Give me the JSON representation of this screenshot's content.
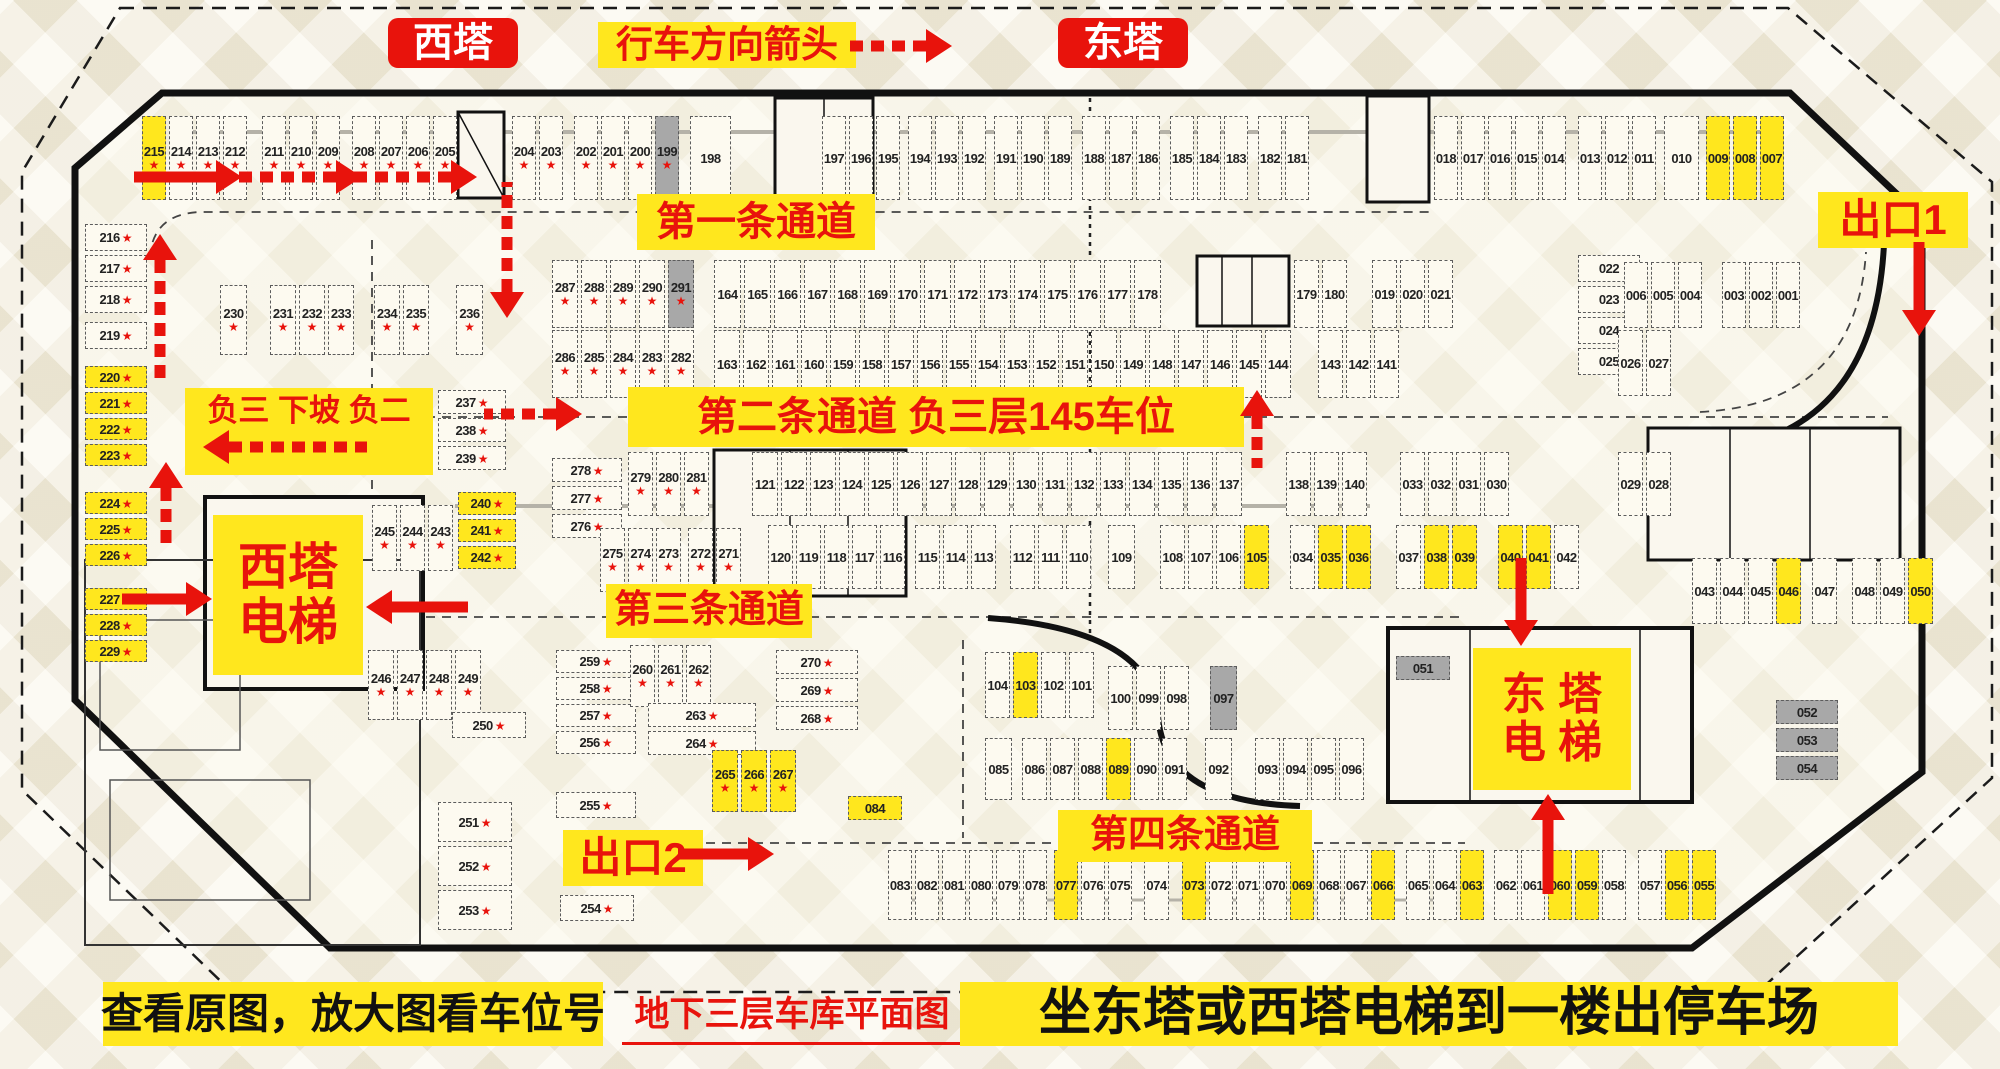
{
  "header": {
    "west_tower": "西塔",
    "direction_label": "行车方向箭头",
    "east_tower": "东塔"
  },
  "labels": {
    "lane1": "第一条通道",
    "lane2": "第二条通道 负三层145车位",
    "lane3": "第三条通道",
    "lane4": "第四条通道",
    "exit1": "出口1",
    "exit2": "出口2",
    "ramp_note": "负三 下坡 负二",
    "west_elevator_line1": "西塔",
    "west_elevator_line2": "电梯",
    "east_elevator_line1": "东 塔",
    "east_elevator_line2": "电 梯"
  },
  "footer": {
    "left_note": "查看原图，放大图看车位号",
    "center_title": "地下三层车库平面图",
    "right_note": "坐东塔或西塔电梯到一楼出停车场"
  },
  "colors": {
    "accent_red": "#e8130c",
    "highlight_yellow": "#ffe71e",
    "occupied_gray": "#a8a8a8",
    "star_red": "#e8130c"
  },
  "legend_note": "cell flags: y=yellow highlight, g=gray, s=red star",
  "groups": [
    {
      "id": "top-215",
      "o": "v",
      "x": 142,
      "y": 116,
      "cw": 27,
      "ch": 84,
      "cells": [
        "215:ys",
        "214:s",
        "213:s",
        "212:s"
      ]
    },
    {
      "id": "top-211",
      "o": "v",
      "x": 262,
      "y": 116,
      "cw": 27,
      "ch": 84,
      "cells": [
        "211:s",
        "210:s",
        "209:s"
      ]
    },
    {
      "id": "top-208",
      "o": "v",
      "x": 352,
      "y": 116,
      "cw": 27,
      "ch": 84,
      "cells": [
        "208:s",
        "207:s"
      ]
    },
    {
      "id": "top-206",
      "o": "v",
      "x": 406,
      "y": 116,
      "cw": 27,
      "ch": 84,
      "cells": [
        "206:s",
        "205:s"
      ]
    },
    {
      "id": "top-204",
      "o": "v",
      "x": 512,
      "y": 116,
      "cw": 27,
      "ch": 84,
      "cells": [
        "204:s",
        "203:s"
      ]
    },
    {
      "id": "top-202",
      "o": "v",
      "x": 574,
      "y": 116,
      "cw": 27,
      "ch": 84,
      "cells": [
        "202:s",
        "201:s",
        "200:s",
        "199:sg"
      ]
    },
    {
      "id": "top-198",
      "o": "v",
      "x": 690,
      "y": 116,
      "cw": 44,
      "ch": 84,
      "cells": [
        "198"
      ]
    },
    {
      "id": "top-197",
      "o": "v",
      "x": 822,
      "y": 116,
      "cw": 27,
      "ch": 84,
      "cells": [
        "197",
        "196",
        "195"
      ]
    },
    {
      "id": "top-194",
      "o": "v",
      "x": 908,
      "y": 116,
      "cw": 27,
      "ch": 84,
      "cells": [
        "194",
        "193",
        "192"
      ]
    },
    {
      "id": "top-191",
      "o": "v",
      "x": 994,
      "y": 116,
      "cw": 27,
      "ch": 84,
      "cells": [
        "191",
        "190",
        "189"
      ]
    },
    {
      "id": "top-188",
      "o": "v",
      "x": 1082,
      "y": 116,
      "cw": 27,
      "ch": 84,
      "cells": [
        "188",
        "187",
        "186"
      ]
    },
    {
      "id": "top-185",
      "o": "v",
      "x": 1170,
      "y": 116,
      "cw": 27,
      "ch": 84,
      "cells": [
        "185",
        "184",
        "183"
      ]
    },
    {
      "id": "top-182",
      "o": "v",
      "x": 1258,
      "y": 116,
      "cw": 27,
      "ch": 84,
      "cells": [
        "182",
        "181"
      ]
    },
    {
      "id": "top-018",
      "o": "v",
      "x": 1434,
      "y": 116,
      "cw": 27,
      "ch": 84,
      "cells": [
        "018",
        "017",
        "016",
        "015",
        "014"
      ]
    },
    {
      "id": "top-013",
      "o": "v",
      "x": 1578,
      "y": 116,
      "cw": 27,
      "ch": 84,
      "cells": [
        "013",
        "012",
        "011"
      ]
    },
    {
      "id": "top-010",
      "o": "v",
      "x": 1664,
      "y": 116,
      "cw": 38,
      "ch": 84,
      "cells": [
        "010"
      ]
    },
    {
      "id": "top-009",
      "o": "v",
      "x": 1706,
      "y": 116,
      "cw": 27,
      "ch": 84,
      "cells": [
        "009:y",
        "008:y",
        "007:y"
      ]
    },
    {
      "id": "left-216",
      "o": "h",
      "x": 85,
      "y": 224,
      "cw": 62,
      "ch": 31,
      "cells": [
        "216:s",
        "217:s",
        "218:s"
      ]
    },
    {
      "id": "left-219",
      "o": "h",
      "x": 85,
      "y": 322,
      "cw": 62,
      "ch": 31,
      "cells": [
        "219:s"
      ]
    },
    {
      "id": "left-220",
      "o": "h",
      "x": 85,
      "y": 366,
      "cw": 62,
      "ch": 26,
      "cells": [
        "220:ys",
        "221:ys",
        "222:ys",
        "223:ys"
      ]
    },
    {
      "id": "left-224",
      "o": "h",
      "x": 85,
      "y": 492,
      "cw": 62,
      "ch": 26,
      "cells": [
        "224:ys",
        "225:ys",
        "226:ys"
      ]
    },
    {
      "id": "left-227",
      "o": "h",
      "x": 85,
      "y": 588,
      "cw": 62,
      "ch": 26,
      "cells": [
        "227:ys",
        "228:ys",
        "229:ys"
      ]
    },
    {
      "id": "row2-230",
      "o": "v",
      "x": 220,
      "y": 285,
      "cw": 30,
      "ch": 70,
      "cells": [
        "230:s"
      ]
    },
    {
      "id": "row2-231",
      "o": "v",
      "x": 270,
      "y": 285,
      "cw": 29,
      "ch": 70,
      "cells": [
        "231:s",
        "232:s",
        "233:s"
      ]
    },
    {
      "id": "row2-234",
      "o": "v",
      "x": 374,
      "y": 285,
      "cw": 29,
      "ch": 70,
      "cells": [
        "234:s",
        "235:s"
      ]
    },
    {
      "id": "row2-236",
      "o": "v",
      "x": 456,
      "y": 285,
      "cw": 30,
      "ch": 70,
      "cells": [
        "236:s"
      ]
    },
    {
      "id": "c-287",
      "o": "v",
      "x": 552,
      "y": 260,
      "cw": 29,
      "ch": 68,
      "cells": [
        "287:s",
        "288:s",
        "289:s",
        "290:s",
        "291:sg"
      ]
    },
    {
      "id": "c-286",
      "o": "v",
      "x": 552,
      "y": 330,
      "cw": 29,
      "ch": 68,
      "cells": [
        "286:s",
        "285:s",
        "284:s",
        "283:s",
        "282:s"
      ]
    },
    {
      "id": "c-164",
      "o": "v",
      "x": 714,
      "y": 260,
      "cw": 30,
      "ch": 68,
      "cells": [
        "164",
        "165",
        "166",
        "167",
        "168",
        "169",
        "170",
        "171",
        "172",
        "173",
        "174",
        "175",
        "176",
        "177",
        "178"
      ]
    },
    {
      "id": "c-179",
      "o": "v",
      "x": 1294,
      "y": 260,
      "cw": 28,
      "ch": 68,
      "cells": [
        "179",
        "180"
      ]
    },
    {
      "id": "c-019",
      "o": "v",
      "x": 1372,
      "y": 260,
      "cw": 28,
      "ch": 68,
      "cells": [
        "019",
        "020",
        "021"
      ]
    },
    {
      "id": "c-163",
      "o": "v",
      "x": 714,
      "y": 330,
      "cw": 29,
      "ch": 68,
      "cells": [
        "163",
        "162",
        "161",
        "160",
        "159",
        "158",
        "157",
        "156",
        "155",
        "154",
        "153",
        "152",
        "151",
        "150",
        "149",
        "148",
        "147",
        "146",
        "145",
        "144"
      ]
    },
    {
      "id": "c-143",
      "o": "v",
      "x": 1318,
      "y": 330,
      "cw": 28,
      "ch": 68,
      "cells": [
        "143",
        "142",
        "141"
      ]
    },
    {
      "id": "rb-022",
      "o": "h",
      "x": 1578,
      "y": 255,
      "cw": 62,
      "ch": 31,
      "cells": [
        "022",
        "023",
        "024",
        "025"
      ]
    },
    {
      "id": "rb-006",
      "o": "v",
      "x": 1624,
      "y": 262,
      "cw": 27,
      "ch": 66,
      "cells": [
        "006",
        "005",
        "004"
      ]
    },
    {
      "id": "rb-003",
      "o": "v",
      "x": 1722,
      "y": 262,
      "cw": 27,
      "ch": 66,
      "cells": [
        "003",
        "002",
        "001"
      ]
    },
    {
      "id": "rb-026",
      "o": "v",
      "x": 1618,
      "y": 330,
      "cw": 28,
      "ch": 66,
      "cells": [
        "026",
        "027"
      ]
    },
    {
      "id": "m-237",
      "o": "h",
      "x": 438,
      "y": 390,
      "cw": 68,
      "ch": 28,
      "cells": [
        "237:s",
        "238:s",
        "239:s"
      ]
    },
    {
      "id": "m-240",
      "o": "h",
      "x": 458,
      "y": 492,
      "cw": 58,
      "ch": 27,
      "cells": [
        "240:ys",
        "241:ys",
        "242:ys"
      ]
    },
    {
      "id": "m-245",
      "o": "v",
      "x": 372,
      "y": 505,
      "cw": 28,
      "ch": 66,
      "cells": [
        "245:s",
        "244:s",
        "243:s"
      ]
    },
    {
      "id": "n-278",
      "o": "h",
      "x": 552,
      "y": 458,
      "cw": 70,
      "ch": 28,
      "cells": [
        "278:s",
        "277:s",
        "276:s"
      ]
    },
    {
      "id": "n-279",
      "o": "v",
      "x": 628,
      "y": 452,
      "cw": 28,
      "ch": 64,
      "cells": [
        "279:s",
        "280:s",
        "281:s"
      ]
    },
    {
      "id": "n-275",
      "o": "v",
      "x": 600,
      "y": 528,
      "cw": 28,
      "ch": 64,
      "cells": [
        "275:s",
        "274:s",
        "273:s"
      ]
    },
    {
      "id": "n-272",
      "o": "v",
      "x": 688,
      "y": 528,
      "cw": 28,
      "ch": 64,
      "cells": [
        "272:s",
        "271:s"
      ]
    },
    {
      "id": "n-121",
      "o": "v",
      "x": 752,
      "y": 452,
      "cw": 29,
      "ch": 64,
      "cells": [
        "121",
        "122",
        "123",
        "124",
        "125",
        "126",
        "127",
        "128",
        "129",
        "130",
        "131",
        "132",
        "133",
        "134",
        "135",
        "136",
        "137"
      ]
    },
    {
      "id": "n-138",
      "o": "v",
      "x": 1286,
      "y": 452,
      "cw": 28,
      "ch": 64,
      "cells": [
        "138",
        "139",
        "140"
      ]
    },
    {
      "id": "n-033",
      "o": "v",
      "x": 1400,
      "y": 452,
      "cw": 28,
      "ch": 64,
      "cells": [
        "033",
        "032",
        "031",
        "030"
      ]
    },
    {
      "id": "n-029",
      "o": "v",
      "x": 1618,
      "y": 452,
      "cw": 28,
      "ch": 64,
      "cells": [
        "029",
        "028"
      ]
    },
    {
      "id": "n-120",
      "o": "v",
      "x": 768,
      "y": 525,
      "cw": 28,
      "ch": 64,
      "cells": [
        "120",
        "119",
        "118",
        "117",
        "116"
      ]
    },
    {
      "id": "n-115",
      "o": "v",
      "x": 915,
      "y": 525,
      "cw": 28,
      "ch": 64,
      "cells": [
        "115",
        "114",
        "113"
      ]
    },
    {
      "id": "n-112",
      "o": "v",
      "x": 1010,
      "y": 525,
      "cw": 28,
      "ch": 64,
      "cells": [
        "112",
        "111",
        "110"
      ]
    },
    {
      "id": "n-109",
      "o": "v",
      "x": 1108,
      "y": 525,
      "cw": 30,
      "ch": 64,
      "cells": [
        "109"
      ]
    },
    {
      "id": "n-108",
      "o": "v",
      "x": 1160,
      "y": 525,
      "cw": 28,
      "ch": 64,
      "cells": [
        "108",
        "107",
        "106",
        "105:y"
      ]
    },
    {
      "id": "n-034",
      "o": "v",
      "x": 1290,
      "y": 525,
      "cw": 28,
      "ch": 64,
      "cells": [
        "034",
        "035:y",
        "036:y"
      ]
    },
    {
      "id": "n-037",
      "o": "v",
      "x": 1396,
      "y": 525,
      "cw": 28,
      "ch": 64,
      "cells": [
        "037",
        "038:y",
        "039:y"
      ]
    },
    {
      "id": "n-040",
      "o": "v",
      "x": 1498,
      "y": 525,
      "cw": 28,
      "ch": 64,
      "cells": [
        "040:y",
        "041:y",
        "042"
      ]
    },
    {
      "id": "n-043",
      "o": "v",
      "x": 1692,
      "y": 558,
      "cw": 28,
      "ch": 66,
      "cells": [
        "043",
        "044",
        "045",
        "046:y"
      ]
    },
    {
      "id": "n-047",
      "o": "v",
      "x": 1812,
      "y": 558,
      "cw": 28,
      "ch": 66,
      "cells": [
        "047"
      ]
    },
    {
      "id": "n-048",
      "o": "v",
      "x": 1852,
      "y": 558,
      "cw": 28,
      "ch": 66,
      "cells": [
        "048",
        "049",
        "050:y"
      ]
    },
    {
      "id": "b-246",
      "o": "v",
      "x": 368,
      "y": 650,
      "cw": 29,
      "ch": 70,
      "cells": [
        "246:s",
        "247:s",
        "248:s",
        "249:s"
      ]
    },
    {
      "id": "b-250",
      "o": "h",
      "x": 452,
      "y": 712,
      "cw": 74,
      "ch": 30,
      "cells": [
        "250:s"
      ]
    },
    {
      "id": "b-251",
      "o": "h",
      "x": 438,
      "y": 802,
      "cw": 74,
      "ch": 44,
      "cells": [
        "251:s",
        "252:s",
        "253:s"
      ]
    },
    {
      "id": "b-254",
      "o": "h",
      "x": 560,
      "y": 895,
      "cw": 74,
      "ch": 30,
      "cells": [
        "254:s"
      ]
    },
    {
      "id": "b-259",
      "o": "h",
      "x": 556,
      "y": 650,
      "cw": 80,
      "ch": 27,
      "cells": [
        "259:s",
        "258:s",
        "257:s",
        "256:s"
      ]
    },
    {
      "id": "b-255",
      "o": "h",
      "x": 556,
      "y": 792,
      "cw": 80,
      "ch": 30,
      "cells": [
        "255:s"
      ]
    },
    {
      "id": "b-260",
      "o": "v",
      "x": 630,
      "y": 645,
      "cw": 28,
      "ch": 62,
      "cells": [
        "260:s",
        "261:s",
        "262:s"
      ]
    },
    {
      "id": "b-263",
      "o": "h",
      "x": 648,
      "y": 703,
      "cw": 108,
      "ch": 28,
      "cells": [
        "263:s",
        "264:s"
      ]
    },
    {
      "id": "b-265",
      "o": "v",
      "x": 712,
      "y": 750,
      "cw": 29,
      "ch": 62,
      "cells": [
        "265:ys",
        "266:ys",
        "267:ys"
      ]
    },
    {
      "id": "b-270",
      "o": "h",
      "x": 776,
      "y": 650,
      "cw": 82,
      "ch": 28,
      "cells": [
        "270:s",
        "269:s",
        "268:s"
      ]
    },
    {
      "id": "b-084",
      "o": "h",
      "x": 848,
      "y": 796,
      "cw": 54,
      "ch": 28,
      "cells": [
        "084:y"
      ]
    },
    {
      "id": "bm-104",
      "o": "v",
      "x": 985,
      "y": 652,
      "cw": 28,
      "ch": 66,
      "cells": [
        "104",
        "103:y",
        "102",
        "101"
      ]
    },
    {
      "id": "bm-100",
      "o": "v",
      "x": 1108,
      "y": 666,
      "cw": 28,
      "ch": 64,
      "cells": [
        "100",
        "099",
        "098"
      ]
    },
    {
      "id": "bm-097",
      "o": "v",
      "x": 1210,
      "y": 666,
      "cw": 30,
      "ch": 64,
      "cells": [
        "097:g"
      ]
    },
    {
      "id": "bm-085",
      "o": "v",
      "x": 985,
      "y": 738,
      "cw": 30,
      "ch": 62,
      "cells": [
        "085"
      ]
    },
    {
      "id": "bm-086",
      "o": "v",
      "x": 1022,
      "y": 738,
      "cw": 28,
      "ch": 62,
      "cells": [
        "086",
        "087",
        "088",
        "089:y",
        "090",
        "091"
      ]
    },
    {
      "id": "bm-092",
      "o": "v",
      "x": 1205,
      "y": 738,
      "cw": 30,
      "ch": 62,
      "cells": [
        "092"
      ]
    },
    {
      "id": "bm-093",
      "o": "v",
      "x": 1255,
      "y": 738,
      "cw": 28,
      "ch": 62,
      "cells": [
        "093",
        "094",
        "095",
        "096"
      ]
    },
    {
      "id": "bm-051",
      "o": "h",
      "x": 1396,
      "y": 656,
      "cw": 54,
      "ch": 28,
      "cells": [
        "051:g"
      ]
    },
    {
      "id": "bm-052",
      "o": "h",
      "x": 1776,
      "y": 700,
      "cw": 62,
      "ch": 28,
      "cells": [
        "052:g",
        "053:g",
        "054:g"
      ]
    },
    {
      "id": "br-083",
      "o": "v",
      "x": 888,
      "y": 850,
      "cw": 27,
      "ch": 70,
      "cells": [
        "083",
        "082",
        "081",
        "080",
        "079",
        "078"
      ]
    },
    {
      "id": "br-077",
      "o": "v",
      "x": 1054,
      "y": 850,
      "cw": 27,
      "ch": 70,
      "cells": [
        "077:y",
        "076",
        "075"
      ]
    },
    {
      "id": "br-074",
      "o": "v",
      "x": 1144,
      "y": 850,
      "cw": 28,
      "ch": 70,
      "cells": [
        "074"
      ]
    },
    {
      "id": "br-073",
      "o": "v",
      "x": 1182,
      "y": 850,
      "cw": 27,
      "ch": 70,
      "cells": [
        "073:y",
        "072",
        "071",
        "070",
        "069:y",
        "068",
        "067",
        "066:y"
      ]
    },
    {
      "id": "br-065",
      "o": "v",
      "x": 1406,
      "y": 850,
      "cw": 27,
      "ch": 70,
      "cells": [
        "065",
        "064",
        "063:y"
      ]
    },
    {
      "id": "br-062",
      "o": "v",
      "x": 1494,
      "y": 850,
      "cw": 27,
      "ch": 70,
      "cells": [
        "062",
        "061",
        "060:y",
        "059:y",
        "058"
      ]
    },
    {
      "id": "br-057",
      "o": "v",
      "x": 1638,
      "y": 850,
      "cw": 27,
      "ch": 70,
      "cells": [
        "057",
        "056:y",
        "055:y"
      ]
    }
  ],
  "arrows": [
    {
      "d": "right",
      "x": 952,
      "y": 46,
      "len": 80,
      "dash": true
    },
    {
      "d": "right",
      "x": 242,
      "y": 177,
      "len": 82,
      "dash": false
    },
    {
      "d": "right",
      "x": 362,
      "y": 177,
      "len": 100,
      "dash": true
    },
    {
      "d": "right",
      "x": 477,
      "y": 177,
      "len": 100,
      "dash": true
    },
    {
      "d": "down",
      "x": 507,
      "y": 318,
      "len": 110,
      "dash": true
    },
    {
      "d": "right",
      "x": 582,
      "y": 414,
      "len": 72,
      "dash": true
    },
    {
      "d": "up",
      "x": 160,
      "y": 234,
      "len": 120,
      "dash": true
    },
    {
      "d": "up",
      "x": 166,
      "y": 462,
      "len": 58,
      "dash": true
    },
    {
      "d": "left",
      "x": 203,
      "y": 447,
      "len": 138,
      "dash": true
    },
    {
      "d": "right",
      "x": 212,
      "y": 599,
      "len": 64,
      "dash": false
    },
    {
      "d": "left",
      "x": 366,
      "y": 607,
      "len": 76,
      "dash": false
    },
    {
      "d": "up",
      "x": 1257,
      "y": 390,
      "len": 52,
      "dash": true
    },
    {
      "d": "down",
      "x": 1521,
      "y": 646,
      "len": 62,
      "dash": false
    },
    {
      "d": "up",
      "x": 1548,
      "y": 794,
      "len": 74,
      "dash": false
    },
    {
      "d": "down",
      "x": 1919,
      "y": 336,
      "len": 68,
      "dash": false
    },
    {
      "d": "right",
      "x": 774,
      "y": 854,
      "len": 70,
      "dash": false
    }
  ]
}
